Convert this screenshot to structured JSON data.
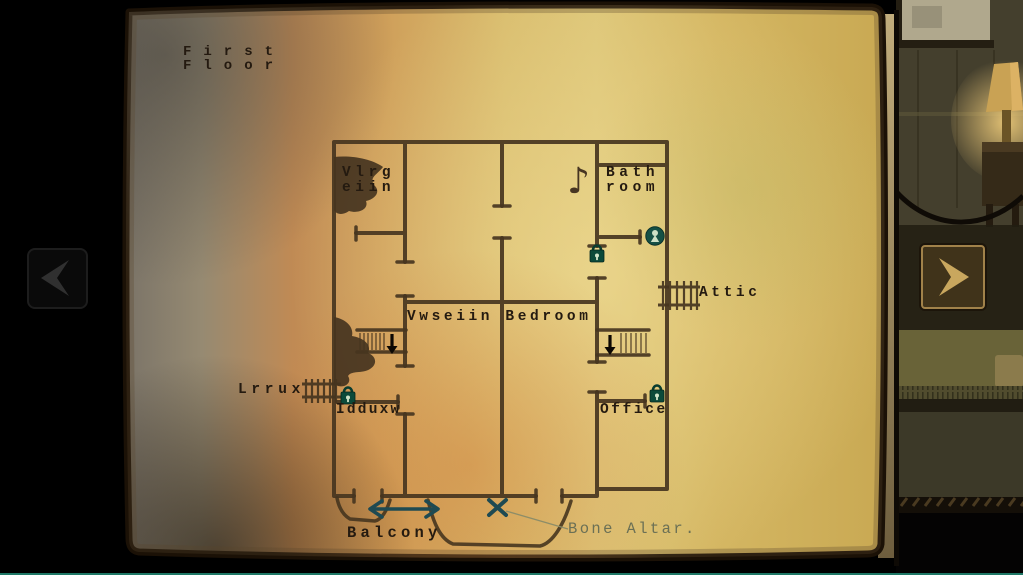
{
  "screen": {
    "bottom_border_color": "#1e7866"
  },
  "map": {
    "title": {
      "line1": "First",
      "line2": "Floor"
    },
    "rooms": {
      "vlrgeiin": {
        "line1": "Vlrg",
        "line2": "eiin"
      },
      "bathroom": {
        "line1": "Bath",
        "line2": "room"
      },
      "bedroom": "Vwseiin Bedroom",
      "attic": "Attic",
      "lrrux": "Lrrux",
      "idduxw": "Idduxw",
      "office": "Office",
      "balcony": "Balcony"
    },
    "annotations": {
      "bone_altar": "Bone Altar.",
      "music_note_glyph": "♪"
    },
    "icons": {
      "locks": [
        "bathroom-door-lock-icon",
        "idduxw-door-lock-icon",
        "office-door-lock-icon"
      ],
      "keyhole": "keyhole-marker-icon",
      "ladders": [
        "attic-ladder-icon",
        "lrrux-ladder-icon"
      ],
      "stairs": [
        "stairs-down-west-icon",
        "stairs-down-east-icon"
      ],
      "balcony_arrow": "balcony-range-arrow-icon",
      "x_mark": "bone-altar-x-icon"
    },
    "colors": {
      "ink": "#46351f",
      "paper_gold": "#dcc475",
      "paper_orange": "#c98f51",
      "lock_green": "#0b4a3a",
      "teal_mark": "#1e4a52",
      "altar_text": "#6b7055"
    }
  },
  "nav": {
    "prev_icon": "chevron-left",
    "next_icon": "chevron-right"
  }
}
